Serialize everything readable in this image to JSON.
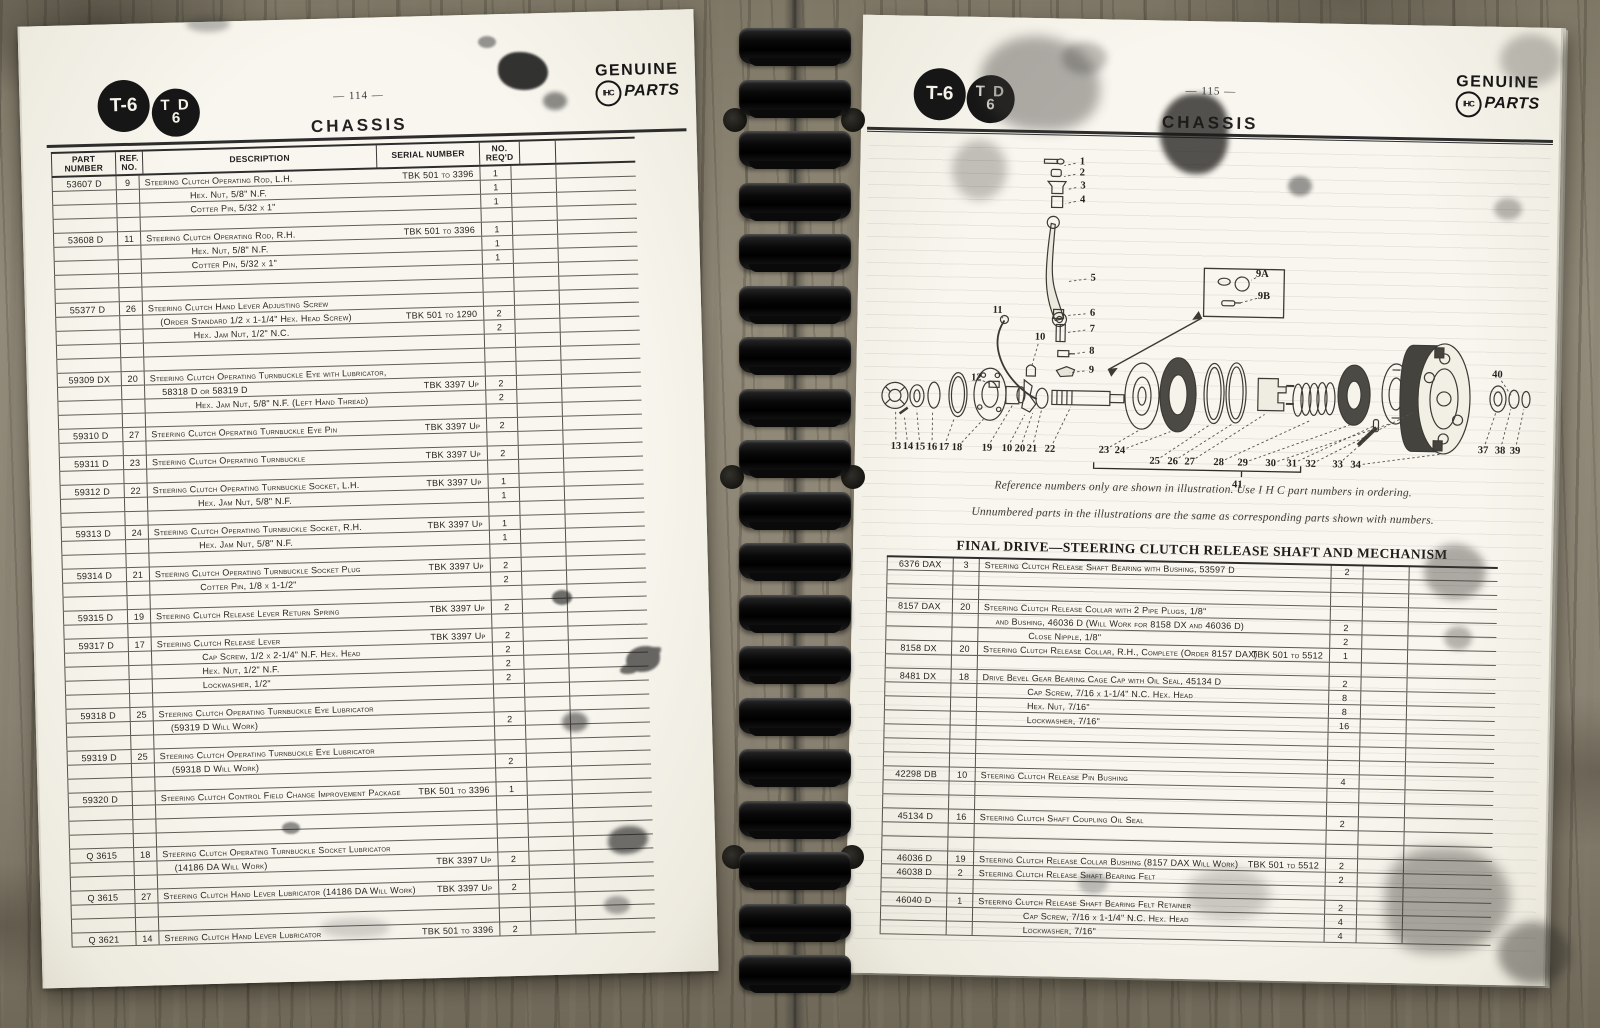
{
  "branding": {
    "model_badge_1": "T-6",
    "model_badge_2_line1": "T D",
    "model_badge_2_line2": "6",
    "genuine": "GENUINE",
    "parts": "PARTS",
    "monogram": "IHC"
  },
  "left_page": {
    "page_number": "— 114 —",
    "title": "CHASSIS",
    "headers": {
      "part": "PART NUMBER",
      "ref": "REF.\nNO.",
      "desc": "DESCRIPTION",
      "serial": "SERIAL NUMBER",
      "qty": "NO.\nREQ'D"
    },
    "rows": [
      [
        "53607 D",
        "9",
        "Steering Clutch Operating Rod, L.H.",
        0,
        "TBK 501 to 3396",
        "1"
      ],
      [
        null,
        null,
        "Hex. Nut, 5/8\" N.F.",
        2,
        null,
        "1"
      ],
      [
        null,
        null,
        "Cotter Pin, 5/32 x 1\"",
        2,
        null,
        "1"
      ],
      null,
      [
        "53608 D",
        "11",
        "Steering Clutch Operating Rod, R.H.",
        0,
        "TBK 501 to 3396",
        "1"
      ],
      [
        null,
        null,
        "Hex. Nut, 5/8\" N.F.",
        2,
        null,
        "1"
      ],
      [
        null,
        null,
        "Cotter Pin, 5/32 x 1\"",
        2,
        null,
        "1"
      ],
      null,
      null,
      [
        "55377 D",
        "26",
        "Steering Clutch Hand Lever Adjusting Screw",
        0,
        null,
        null
      ],
      [
        null,
        null,
        "(Order Standard 1/2 x 1-1/4\" Hex. Head Screw)",
        1,
        "TBK 501 to 1290",
        "2"
      ],
      [
        null,
        null,
        "Hex. Jam Nut, 1/2\" N.C.",
        2,
        null,
        "2"
      ],
      null,
      null,
      [
        "59309 DX",
        "20",
        "Steering Clutch Operating Turnbuckle Eye with Lubricator,",
        0,
        null,
        null
      ],
      [
        null,
        null,
        "58318 D or 58319 D",
        1,
        "TBK 3397 Up",
        "2"
      ],
      [
        null,
        null,
        "Hex. Jam Nut, 5/8\" N.F. (Left Hand Thread)",
        2,
        null,
        "2"
      ],
      null,
      [
        "59310 D",
        "27",
        "Steering Clutch Operating Turnbuckle Eye Pin",
        0,
        "TBK 3397 Up",
        "2"
      ],
      null,
      [
        "59311 D",
        "23",
        "Steering Clutch Operating Turnbuckle",
        0,
        "TBK 3397 Up",
        "2"
      ],
      null,
      [
        "59312 D",
        "22",
        "Steering Clutch Operating Turnbuckle Socket, L.H.",
        0,
        "TBK 3397 Up",
        "1"
      ],
      [
        null,
        null,
        "Hex. Jam Nut, 5/8\" N.F.",
        2,
        null,
        "1"
      ],
      null,
      [
        "59313 D",
        "24",
        "Steering Clutch Operating Turnbuckle Socket, R.H.",
        0,
        "TBK 3397 Up",
        "1"
      ],
      [
        null,
        null,
        "Hex. Jam Nut, 5/8\" N.F.",
        2,
        null,
        "1"
      ],
      null,
      [
        "59314 D",
        "21",
        "Steering Clutch Operating Turnbuckle Socket Plug",
        0,
        "TBK 3397 Up",
        "2"
      ],
      [
        null,
        null,
        "Cotter Pin, 1/8 x 1-1/2\"",
        2,
        null,
        "2"
      ],
      null,
      [
        "59315 D",
        "19",
        "Steering Clutch Release Lever Return Spring",
        0,
        "TBK 3397 Up",
        "2"
      ],
      null,
      [
        "59317 D",
        "17",
        "Steering Clutch Release Lever",
        0,
        "TBK 3397 Up",
        "2"
      ],
      [
        null,
        null,
        "Cap Screw, 1/2 x 2-1/4\" N.F. Hex. Head",
        2,
        null,
        "2"
      ],
      [
        null,
        null,
        "Hex. Nut, 1/2\" N.F.",
        2,
        null,
        "2"
      ],
      [
        null,
        null,
        "Lockwasher, 1/2\"",
        2,
        null,
        "2"
      ],
      null,
      [
        "59318 D",
        "25",
        "Steering Clutch Operating Turnbuckle Eye Lubricator",
        0,
        null,
        null
      ],
      [
        null,
        null,
        "(59319 D Will Work)",
        1,
        null,
        "2"
      ],
      null,
      [
        "59319 D",
        "25",
        "Steering Clutch Operating Turnbuckle Eye Lubricator",
        0,
        null,
        null
      ],
      [
        null,
        null,
        "(59318 D Will Work)",
        1,
        null,
        "2"
      ],
      null,
      [
        "59320 D",
        null,
        "Steering Clutch Control Field Change Improvement Package",
        0,
        "TBK 501 to 3396",
        "1"
      ],
      null,
      null,
      null,
      [
        "Q 3615",
        "18",
        "Steering Clutch Operating Turnbuckle Socket Lubricator",
        0,
        null,
        null
      ],
      [
        null,
        null,
        "(14186 DA Will Work)",
        1,
        "TBK 3397 Up",
        "2"
      ],
      null,
      [
        "Q 3615",
        "27",
        "Steering Clutch Hand Lever Lubricator (14186 DA Will Work)",
        0,
        "TBK 3397 Up",
        "2"
      ],
      null,
      null,
      [
        "Q 3621",
        "14",
        "Steering Clutch Hand Lever Lubricator",
        0,
        "TBK 501 to 3396",
        "2"
      ]
    ]
  },
  "right_page": {
    "page_number": "— 115 —",
    "title": "CHASSIS",
    "notes": [
      "Reference numbers only are shown in illustration.    Use I H C part numbers in ordering.",
      "Unnumbered parts in the illustrations are the same as corresponding parts shown with numbers."
    ],
    "section_title": "FINAL DRIVE—STEERING CLUTCH RELEASE SHAFT AND MECHANISM",
    "rows": [
      [
        "6376 DAX",
        "3",
        "Steering Clutch Release Shaft Bearing with Bushing, 53597 D",
        0,
        null,
        "2"
      ],
      null,
      null,
      [
        "8157 DAX",
        "20",
        "Steering Clutch Release Collar with 2 Pipe Plugs, 1/8\"",
        0,
        null,
        null
      ],
      [
        null,
        null,
        "and Bushing, 46036 D (Will Work for 8158 DX and 46036 D)",
        1,
        null,
        "2"
      ],
      [
        null,
        null,
        "Close Nipple, 1/8\"",
        2,
        null,
        "2"
      ],
      [
        "8158 DX",
        "20",
        "Steering Clutch Release Collar, R.H., Complete (Order 8157 DAX)",
        0,
        "TBK 501 to 5512",
        "1"
      ],
      null,
      [
        "8481 DX",
        "18",
        "Drive Bevel Gear Bearing Cage Cap with Oil Seal, 45134 D",
        0,
        null,
        "2"
      ],
      [
        null,
        null,
        "Cap Screw, 7/16 x 1-1/4\" N.C. Hex. Head",
        2,
        null,
        "8"
      ],
      [
        null,
        null,
        "Hex. Nut, 7/16\"",
        2,
        null,
        "8"
      ],
      [
        null,
        null,
        "Lockwasher, 7/16\"",
        2,
        null,
        "16"
      ],
      null,
      null,
      null,
      [
        "42298 DB",
        "10",
        "Steering Clutch Release Pin Bushing",
        0,
        null,
        "4"
      ],
      null,
      null,
      [
        "45134 D",
        "16",
        "Steering Clutch Shaft Coupling Oil Seal",
        0,
        null,
        "2"
      ],
      null,
      null,
      [
        "46036 D",
        "19",
        "Steering Clutch Release Collar Bushing (8157 DAX Will Work)",
        0,
        "TBK 501 to 5512",
        "2"
      ],
      [
        "46038 D",
        "2",
        "Steering Clutch Release Shaft Bearing Felt",
        0,
        null,
        "2"
      ],
      null,
      [
        "46040 D",
        "1",
        "Steering Clutch Release Shaft Bearing Felt Retainer",
        0,
        null,
        "2"
      ],
      [
        null,
        null,
        "Cap Screw, 7/16 x 1-1/4\" N.C. Hex. Head",
        2,
        null,
        "4"
      ],
      [
        null,
        null,
        "Lockwasher, 7/16\"",
        2,
        null,
        "4"
      ]
    ],
    "diagram": {
      "callouts": [
        {
          "n": "1",
          "x": 222,
          "y": 143,
          "lx": 204,
          "ly": 147
        },
        {
          "n": "2",
          "x": 222,
          "y": 154,
          "lx": 204,
          "ly": 158
        },
        {
          "n": "3",
          "x": 223,
          "y": 167,
          "lx": 207,
          "ly": 171
        },
        {
          "n": "4",
          "x": 223,
          "y": 181,
          "lx": 206,
          "ly": 185
        },
        {
          "n": "5",
          "x": 235,
          "y": 259,
          "lx": 209,
          "ly": 263
        },
        {
          "n": "6",
          "x": 235,
          "y": 294,
          "lx": 208,
          "ly": 297
        },
        {
          "n": "7",
          "x": 235,
          "y": 310,
          "lx": 209,
          "ly": 314
        },
        {
          "n": "8",
          "x": 235,
          "y": 332,
          "lx": 211,
          "ly": 336
        },
        {
          "n": "9",
          "x": 235,
          "y": 351,
          "lx": 213,
          "ly": 354
        },
        {
          "n": "11",
          "x": 140,
          "y": 293,
          "lx": 147,
          "ly": 303
        },
        {
          "n": "10",
          "x": 183,
          "y": 319,
          "lx": 175,
          "ly": 349
        },
        {
          "n": "12",
          "x": 120,
          "y": 361,
          "lx": 135,
          "ly": 367
        },
        {
          "n": "9A",
          "x": 404,
          "y": 252,
          "lx": 393,
          "ly": 258
        },
        {
          "n": "9B",
          "x": 406,
          "y": 274,
          "lx": 382,
          "ly": 281
        },
        {
          "n": "13",
          "x": 41,
          "y": 431,
          "lx": 40,
          "ly": 396
        },
        {
          "n": "14",
          "x": 53,
          "y": 431,
          "lx": 49,
          "ly": 402
        },
        {
          "n": "15",
          "x": 65,
          "y": 431,
          "lx": 61,
          "ly": 394
        },
        {
          "n": "16",
          "x": 77,
          "y": 431,
          "lx": 77,
          "ly": 394
        },
        {
          "n": "17",
          "x": 89,
          "y": 431,
          "lx": 99,
          "ly": 401
        },
        {
          "n": "18",
          "x": 102,
          "y": 431,
          "lx": 128,
          "ly": 402
        },
        {
          "n": "19",
          "x": 132,
          "y": 431,
          "lx": 157,
          "ly": 387
        },
        {
          "n": "10",
          "x": 152,
          "y": 431,
          "lx": 169,
          "ly": 397
        },
        {
          "n": "20",
          "x": 165,
          "y": 431,
          "lx": 177,
          "ly": 395
        },
        {
          "n": "21",
          "x": 177,
          "y": 431,
          "lx": 186,
          "ly": 391
        },
        {
          "n": "22",
          "x": 195,
          "y": 431,
          "lx": 215,
          "ly": 388
        },
        {
          "n": "23",
          "x": 249,
          "y": 431,
          "lx": 284,
          "ly": 410
        },
        {
          "n": "24",
          "x": 265,
          "y": 431,
          "lx": 315,
          "ly": 411
        },
        {
          "n": "25",
          "x": 300,
          "y": 441,
          "lx": 355,
          "ly": 403
        },
        {
          "n": "26",
          "x": 318,
          "y": 441,
          "lx": 377,
          "ly": 402
        },
        {
          "n": "27",
          "x": 335,
          "y": 441,
          "lx": 409,
          "ly": 392
        },
        {
          "n": "28",
          "x": 364,
          "y": 441,
          "lx": 455,
          "ly": 397
        },
        {
          "n": "29",
          "x": 388,
          "y": 441,
          "lx": 494,
          "ly": 401
        },
        {
          "n": "30",
          "x": 416,
          "y": 441,
          "lx": 534,
          "ly": 399
        },
        {
          "n": "31",
          "x": 437,
          "y": 441,
          "lx": 519,
          "ly": 401
        },
        {
          "n": "32",
          "x": 456,
          "y": 441,
          "lx": 556,
          "ly": 388
        },
        {
          "n": "33",
          "x": 483,
          "y": 441,
          "lx": 511,
          "ly": 415
        },
        {
          "n": "34",
          "x": 501,
          "y": 441,
          "lx": 588,
          "ly": 428
        },
        {
          "n": "37",
          "x": 628,
          "y": 424,
          "lx": 640,
          "ly": 386
        },
        {
          "n": "38",
          "x": 645,
          "y": 424,
          "lx": 655,
          "ly": 382
        },
        {
          "n": "39",
          "x": 660,
          "y": 424,
          "lx": 668,
          "ly": 382
        },
        {
          "n": "40",
          "x": 641,
          "y": 348,
          "lx": 655,
          "ly": 368
        }
      ],
      "bracket": {
        "x1": 239,
        "x2": 446,
        "y": 449,
        "tick": 387,
        "label": "41",
        "label_x": 383,
        "label_y": 459
      }
    }
  }
}
